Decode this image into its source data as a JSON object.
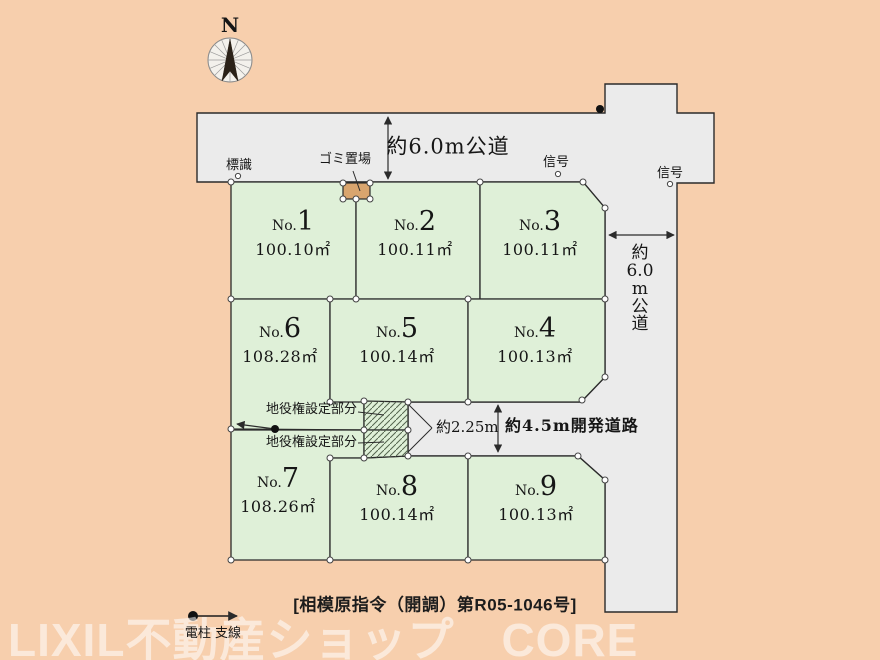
{
  "compass": {
    "north_label": "N"
  },
  "roads": {
    "top_road_label": "約6.0m公道",
    "right_road_label_chars": [
      "約",
      "6.0",
      "m",
      "公",
      "道"
    ],
    "dev_road_label": "約4.5m開発道路",
    "entrance_width_label": "約2.25m"
  },
  "annotations": {
    "sign_label": "標識",
    "garbage_label": "ゴミ置場",
    "signal_label_1": "信号",
    "signal_label_2": "信号",
    "easement_label_1": "地役権設定部分",
    "easement_label_2": "地役権設定部分",
    "legend_label": "電柱 支線"
  },
  "lots": [
    {
      "prefix": "No.",
      "num": "1",
      "area": "100.10㎡"
    },
    {
      "prefix": "No.",
      "num": "2",
      "area": "100.11㎡"
    },
    {
      "prefix": "No.",
      "num": "3",
      "area": "100.11㎡"
    },
    {
      "prefix": "No.",
      "num": "4",
      "area": "100.13㎡"
    },
    {
      "prefix": "No.",
      "num": "5",
      "area": "100.14㎡"
    },
    {
      "prefix": "No.",
      "num": "6",
      "area": "108.28㎡"
    },
    {
      "prefix": "No.",
      "num": "7",
      "area": "108.26㎡"
    },
    {
      "prefix": "No.",
      "num": "8",
      "area": "100.14㎡"
    },
    {
      "prefix": "No.",
      "num": "9",
      "area": "100.13㎡"
    }
  ],
  "footer": {
    "approval_number": "[相模原指令（開調）第R05-1046号]",
    "watermark": "LIXIL不動産ショップ　CORE"
  },
  "colors": {
    "background": "#f7cfad",
    "road": "#ebebeb",
    "lot": "#dff0d8",
    "garbage_station": "#d9a56e",
    "outline": "#2b2b2b"
  }
}
